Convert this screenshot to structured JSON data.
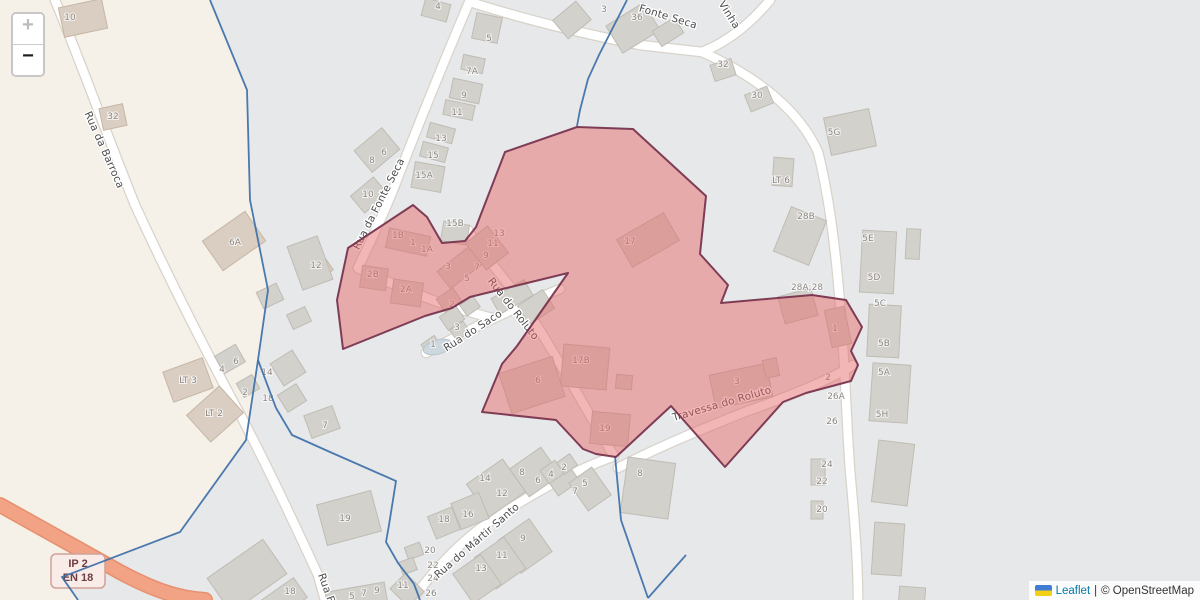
{
  "controls": {
    "zoom_in_label": "+",
    "zoom_out_label": "−"
  },
  "attribution": {
    "flag_icon": "ukraine-flag-icon",
    "leaflet_link": "Leaflet",
    "separator": "|",
    "osm_text": "© OpenStreetMap"
  },
  "road_shield": {
    "line1": "IP 2",
    "line2": "EN 18"
  },
  "street_labels": [
    {
      "text": "Rua da Barroca",
      "x": 104,
      "y": 150,
      "rot": 66
    },
    {
      "text": "Rua da Fonte Seca",
      "x": 379,
      "y": 204,
      "rot": -63
    },
    {
      "text": "Fonte Seca",
      "x": 668,
      "y": 17,
      "rot": 17
    },
    {
      "text": "Vinha",
      "x": 729,
      "y": 15,
      "rot": 58
    },
    {
      "text": "Rua do Saco",
      "x": 473,
      "y": 331,
      "rot": -33
    },
    {
      "text": "Rua do Roluto",
      "x": 513,
      "y": 309,
      "rot": 52
    },
    {
      "text": "Travessa do Roluto",
      "x": 722,
      "y": 404,
      "rot": -16
    },
    {
      "text": "Rua do Mártir Santo",
      "x": 477,
      "y": 541,
      "rot": -41
    },
    {
      "text": "Rua F",
      "x": 326,
      "y": 588,
      "rot": 70
    }
  ],
  "house_numbers": [
    [
      "10",
      70,
      17
    ],
    [
      "32",
      113,
      116
    ],
    [
      "6A",
      235,
      242
    ],
    [
      "LT 3",
      188,
      380
    ],
    [
      "LT 2",
      214,
      413
    ],
    [
      "4",
      438,
      6
    ],
    [
      "5",
      489,
      38
    ],
    [
      "7A",
      472,
      71
    ],
    [
      "9",
      464,
      95
    ],
    [
      "11",
      457,
      112
    ],
    [
      "13",
      441,
      138
    ],
    [
      "15",
      433,
      155
    ],
    [
      "15A",
      424,
      175
    ],
    [
      "8",
      372,
      160
    ],
    [
      "6",
      384,
      152
    ],
    [
      "10",
      368,
      194
    ],
    [
      "3",
      604,
      9
    ],
    [
      "36",
      637,
      17
    ],
    [
      "32",
      723,
      64
    ],
    [
      "30",
      757,
      95
    ],
    [
      "5G",
      834,
      132
    ],
    [
      "LT 6",
      781,
      180
    ],
    [
      "28B",
      806,
      216
    ],
    [
      "5E",
      868,
      238
    ],
    [
      "5D",
      874,
      277
    ],
    [
      "28A;28",
      807,
      287
    ],
    [
      "5C",
      880,
      303
    ],
    [
      "5B",
      884,
      343
    ],
    [
      "5A",
      884,
      372
    ],
    [
      "5H",
      882,
      414
    ],
    [
      "26A",
      836,
      396
    ],
    [
      "26",
      832,
      421
    ],
    [
      "24",
      827,
      464
    ],
    [
      "22",
      822,
      481
    ],
    [
      "20",
      822,
      509
    ],
    [
      "12",
      316,
      265
    ],
    [
      "14",
      267,
      372
    ],
    [
      "18",
      268,
      398
    ],
    [
      "4",
      222,
      369
    ],
    [
      "6",
      236,
      361
    ],
    [
      "2",
      245,
      392
    ],
    [
      "7",
      325,
      425
    ],
    [
      "19",
      345,
      518
    ],
    [
      "18",
      290,
      591
    ],
    [
      "11",
      403,
      585
    ],
    [
      "5",
      352,
      596
    ],
    [
      "7",
      364,
      593
    ],
    [
      "9",
      377,
      590
    ],
    [
      "14",
      485,
      478
    ],
    [
      "12",
      502,
      493
    ],
    [
      "8",
      522,
      472
    ],
    [
      "6",
      538,
      480
    ],
    [
      "4",
      551,
      474
    ],
    [
      "2",
      564,
      467
    ],
    [
      "16",
      468,
      514
    ],
    [
      "18",
      444,
      519
    ],
    [
      "7",
      575,
      491
    ],
    [
      "5",
      585,
      483
    ],
    [
      "9",
      523,
      538
    ],
    [
      "11",
      502,
      555
    ],
    [
      "13",
      481,
      568
    ],
    [
      "8",
      640,
      473
    ],
    [
      "20",
      430,
      550
    ],
    [
      "22",
      433,
      565
    ],
    [
      "24",
      433,
      578
    ],
    [
      "26",
      431,
      593
    ],
    [
      "1",
      433,
      344
    ],
    [
      "3",
      457,
      327
    ],
    [
      "1B",
      398,
      235
    ],
    [
      "1",
      413,
      242
    ],
    [
      "1A",
      427,
      249
    ],
    [
      "3",
      448,
      266
    ],
    [
      "5",
      467,
      278
    ],
    [
      "7",
      477,
      267
    ],
    [
      "9",
      486,
      255
    ],
    [
      "11",
      493,
      243
    ],
    [
      "13",
      499,
      233
    ],
    [
      "15B",
      455,
      223
    ],
    [
      "2B",
      373,
      274
    ],
    [
      "2A",
      406,
      289
    ],
    [
      "2",
      452,
      304
    ],
    [
      "17",
      630,
      241
    ],
    [
      "17B",
      581,
      360
    ],
    [
      "6",
      538,
      380
    ],
    [
      "19",
      605,
      428
    ],
    [
      "3",
      737,
      381
    ],
    [
      "1",
      835,
      328
    ],
    [
      "2",
      828,
      377
    ]
  ],
  "colors": {
    "land": "#f5f1e8",
    "residential": "#e7e8ea",
    "road_case": "#d8d3ca",
    "road_fill": "#ffffff",
    "hwy_case": "#e6906d",
    "hwy_fill": "#f2a285",
    "building_gray_fill": "#d3d1cc",
    "building_gray_stroke": "#bfbcb4",
    "building_beige_fill": "#d9cec1",
    "building_beige_stroke": "#c6b6a4",
    "ellipse_fill": "#cdd7de",
    "ellipse_stroke": "#b8c5cf",
    "boundary": "#3c6fa8",
    "red_fill": "rgba(229,100,100,0.47)",
    "red_stroke": "#732c48",
    "shield_bg": "#f9ebe7",
    "shield_border": "#d2a198",
    "shield_text": "#6f3c41"
  },
  "geometry": {
    "width": 1200,
    "height": 600,
    "zone_gray": "210,0 247,90 250,200 268,290 258,360 246,440 180,532 62,577 78,600 1200,600 1200,0",
    "red_area": "577,127 633,129 706,196 700,254 728,285 721,303 812,295 846,300 862,327 851,351 858,365 851,381 806,393 783,402 725,467 671,406 616,457 596,454 583,449 556,420 482,412 502,364 517,346 568,273 470,297 452,308 425,316 343,349 337,300 348,248 413,205 427,217 442,243 465,241 476,227 505,152",
    "boundaries": [
      "210,0 247,90 250,200 268,290 258,360 246,440 180,532 62,577 78,600",
      "258,360 276,408 292,435 330,452 396,481 389,525 386,542 398,563 414,584 420,600",
      "627,0 599,55 588,79 580,110 577,126",
      "615,456 621,520 648,598",
      "648,598 686,555"
    ],
    "roads": [
      {
        "d": "M55,0 C80,60 105,130 135,205 C165,270 200,340 235,405 C262,455 295,525 318,575 L325,600",
        "k": "r"
      },
      {
        "d": "M470,0 C448,52 420,120 395,185 C378,228 365,252 358,268",
        "k": "r"
      },
      {
        "d": "M358,268 C400,288 430,300 456,308 C470,312 480,315 492,318",
        "k": "r"
      },
      {
        "d": "M426,353 C460,334 505,312 560,289",
        "k": "r"
      },
      {
        "d": "M468,230 C480,252 500,272 520,300 C545,335 585,408 614,456",
        "k": "r"
      },
      {
        "d": "M612,457 C570,472 520,500 478,530 C450,552 428,578 412,600",
        "k": "r"
      },
      {
        "d": "M618,468 C660,446 700,430 745,412 C790,396 830,380 853,365",
        "k": "r"
      },
      {
        "d": "M470,2 C520,18 575,32 640,45 L702,52",
        "k": "r"
      },
      {
        "d": "M770,0 C752,22 728,42 702,52",
        "k": "r"
      },
      {
        "d": "M702,52 C760,78 800,112 818,152 C830,200 836,252 840,305 C845,360 846,415 850,470 C855,525 858,565 858,600",
        "k": "r"
      },
      {
        "d": "M0,505 C40,527 80,550 120,572 C150,588 175,598 205,600",
        "k": "h"
      }
    ],
    "buildings": [
      [
        83,
        18,
        44,
        30,
        -12,
        "b"
      ],
      [
        113,
        117,
        24,
        22,
        -12,
        "b"
      ],
      [
        234,
        241,
        52,
        36,
        -35,
        "b"
      ],
      [
        310,
        256,
        20,
        16,
        -35,
        "b"
      ],
      [
        323,
        269,
        16,
        13,
        -35,
        "b"
      ],
      [
        188,
        380,
        42,
        32,
        -20,
        "b"
      ],
      [
        215,
        414,
        44,
        36,
        -42,
        "b"
      ],
      [
        436,
        10,
        26,
        18,
        15,
        "g"
      ],
      [
        487,
        28,
        26,
        26,
        12,
        "g"
      ],
      [
        473,
        64,
        22,
        15,
        12,
        "g"
      ],
      [
        466,
        91,
        30,
        20,
        12,
        "g"
      ],
      [
        459,
        110,
        30,
        15,
        12,
        "g"
      ],
      [
        441,
        133,
        26,
        15,
        15,
        "g"
      ],
      [
        434,
        152,
        26,
        15,
        15,
        "g"
      ],
      [
        428,
        177,
        30,
        26,
        10,
        "g"
      ],
      [
        455,
        233,
        26,
        20,
        10,
        "g"
      ],
      [
        377,
        150,
        36,
        28,
        -40,
        "g"
      ],
      [
        369,
        195,
        30,
        22,
        -40,
        "g"
      ],
      [
        572,
        20,
        30,
        24,
        -40,
        "g"
      ],
      [
        633,
        28,
        44,
        32,
        -32,
        "g"
      ],
      [
        668,
        32,
        26,
        18,
        -32,
        "g"
      ],
      [
        723,
        70,
        22,
        17,
        -18,
        "g"
      ],
      [
        759,
        99,
        24,
        18,
        -22,
        "g"
      ],
      [
        850,
        132,
        46,
        38,
        -12,
        "g"
      ],
      [
        783,
        172,
        20,
        28,
        4,
        "g"
      ],
      [
        800,
        236,
        38,
        48,
        22,
        "g"
      ],
      [
        878,
        262,
        34,
        62,
        3,
        "g"
      ],
      [
        913,
        244,
        14,
        30,
        3,
        "g"
      ],
      [
        884,
        331,
        32,
        52,
        3,
        "g"
      ],
      [
        890,
        393,
        38,
        58,
        4,
        "g"
      ],
      [
        893,
        473,
        36,
        62,
        7,
        "g"
      ],
      [
        888,
        549,
        30,
        52,
        4,
        "g"
      ],
      [
        912,
        596,
        26,
        18,
        4,
        "g"
      ],
      [
        310,
        263,
        32,
        46,
        -20,
        "g"
      ],
      [
        270,
        296,
        22,
        18,
        -25,
        "g"
      ],
      [
        299,
        318,
        20,
        16,
        -25,
        "g"
      ],
      [
        288,
        368,
        26,
        26,
        -32,
        "g"
      ],
      [
        292,
        398,
        22,
        20,
        -32,
        "g"
      ],
      [
        230,
        359,
        24,
        20,
        -30,
        "g"
      ],
      [
        248,
        386,
        18,
        16,
        -30,
        "g"
      ],
      [
        322,
        422,
        30,
        24,
        -20,
        "g"
      ],
      [
        408,
        242,
        42,
        20,
        12,
        "g"
      ],
      [
        462,
        266,
        46,
        22,
        -38,
        "g"
      ],
      [
        487,
        248,
        28,
        34,
        -38,
        "g"
      ],
      [
        374,
        278,
        26,
        22,
        8,
        "g"
      ],
      [
        407,
        293,
        30,
        24,
        8,
        "g"
      ],
      [
        449,
        300,
        20,
        16,
        -35,
        "g"
      ],
      [
        452,
        318,
        20,
        16,
        -35,
        "g"
      ],
      [
        470,
        306,
        16,
        13,
        -35,
        "g"
      ],
      [
        512,
        297,
        38,
        18,
        -30,
        "g"
      ],
      [
        536,
        307,
        30,
        22,
        -33,
        "g"
      ],
      [
        460,
        331,
        16,
        13,
        -35,
        "g"
      ],
      [
        431,
        345,
        16,
        12,
        -35,
        "g"
      ],
      [
        648,
        240,
        54,
        32,
        -30,
        "g"
      ],
      [
        585,
        367,
        46,
        42,
        5,
        "g"
      ],
      [
        624,
        382,
        16,
        14,
        5,
        "g"
      ],
      [
        532,
        385,
        56,
        42,
        -18,
        "g"
      ],
      [
        610,
        429,
        38,
        32,
        5,
        "g"
      ],
      [
        741,
        386,
        58,
        34,
        -12,
        "g"
      ],
      [
        771,
        368,
        14,
        18,
        -12,
        "g"
      ],
      [
        838,
        327,
        20,
        38,
        -12,
        "g"
      ],
      [
        798,
        306,
        34,
        28,
        -15,
        "g"
      ],
      [
        349,
        518,
        56,
        42,
        -15,
        "g"
      ],
      [
        247,
        576,
        68,
        42,
        -35,
        "g"
      ],
      [
        284,
        599,
        40,
        24,
        -35,
        "g"
      ],
      [
        496,
        488,
        44,
        40,
        -35,
        "g"
      ],
      [
        535,
        472,
        38,
        34,
        -35,
        "g"
      ],
      [
        561,
        477,
        26,
        28,
        -35,
        "g"
      ],
      [
        567,
        464,
        16,
        14,
        -35,
        "g"
      ],
      [
        552,
        472,
        18,
        16,
        -35,
        "g"
      ],
      [
        470,
        511,
        30,
        28,
        -22,
        "g"
      ],
      [
        444,
        523,
        26,
        24,
        -22,
        "g"
      ],
      [
        590,
        489,
        28,
        34,
        -35,
        "g"
      ],
      [
        648,
        488,
        48,
        56,
        8,
        "g"
      ],
      [
        525,
        546,
        38,
        40,
        -35,
        "g"
      ],
      [
        500,
        563,
        36,
        38,
        -35,
        "g"
      ],
      [
        477,
        579,
        34,
        36,
        -35,
        "g"
      ],
      [
        407,
        590,
        26,
        22,
        45,
        "g"
      ],
      [
        357,
        601,
        60,
        28,
        -10,
        "g"
      ],
      [
        414,
        551,
        16,
        13,
        -20,
        "g"
      ],
      [
        408,
        566,
        15,
        13,
        -20,
        "g"
      ],
      [
        818,
        472,
        14,
        26,
        0,
        "g"
      ],
      [
        817,
        510,
        12,
        18,
        0,
        "g"
      ]
    ],
    "ellipses": [
      [
        438,
        347,
        15,
        7,
        -15
      ]
    ],
    "shield": {
      "x": 78,
      "y": 571,
      "w": 54,
      "h": 34
    }
  }
}
